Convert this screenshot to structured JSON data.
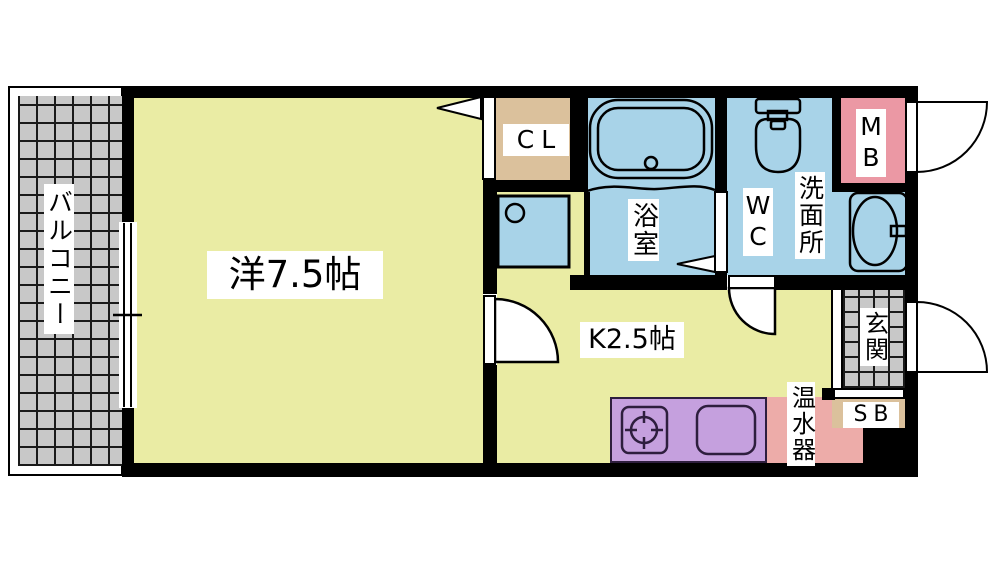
{
  "floorplan": {
    "rooms": {
      "balcony": {
        "label": "バルコニー"
      },
      "western_room": {
        "label": "洋7.5帖"
      },
      "closet": {
        "label": "CL"
      },
      "kitchen": {
        "label": "K2.5帖"
      },
      "bathroom": {
        "label": "浴室"
      },
      "wc": {
        "label": "WC"
      },
      "washroom": {
        "label": "洗面所"
      },
      "meter_box": {
        "label": "MB"
      },
      "entrance": {
        "label": "玄関"
      },
      "shoe_box": {
        "label": "SB"
      },
      "water_heater": {
        "label": "温水器"
      }
    },
    "colors": {
      "floor-yellow": "#eaeca4",
      "wet-blue": "#a8d3e8",
      "closet-tan": "#dbc19c",
      "meter-pink": "#eb98a4",
      "heater-pink": "#edaca9",
      "counter-purple": "#c5a0de",
      "tile-gray": "#c8c8c8",
      "wall-black": "#000000",
      "grid-line": "#1a1a1a"
    }
  }
}
